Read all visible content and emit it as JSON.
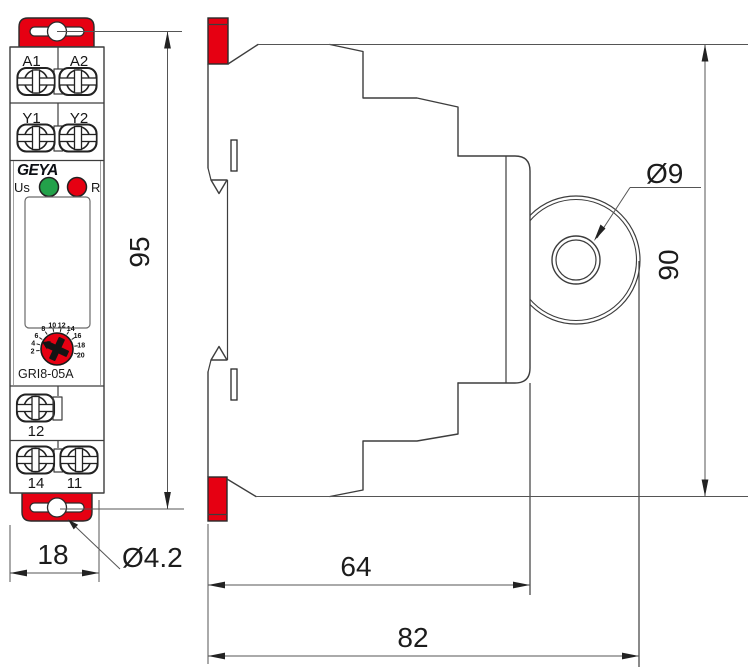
{
  "drawing": {
    "front_view": {
      "terminal_labels_row1": [
        "A1",
        "A2"
      ],
      "terminal_labels_row2": [
        "Y1",
        "Y2"
      ],
      "brand": "GEYA",
      "led_power_label": "Us",
      "led_relay_label": "R",
      "model": "GRI8-05A",
      "dial_scale": [
        "2",
        "4",
        "6",
        "8",
        "10",
        "12",
        "14",
        "16",
        "18",
        "20"
      ],
      "terminal_label_12": "12",
      "terminal_label_14": "14",
      "terminal_label_11": "11"
    },
    "dimensions": {
      "front_height": "95",
      "front_width": "18",
      "front_hole_diameter": "Ø4.2",
      "side_height": "90",
      "side_hole_diameter": "Ø9",
      "side_depth_inner": "64",
      "side_depth_total": "82"
    },
    "colors": {
      "accent_red": "#e60012",
      "led_green": "#23a14a",
      "line_dark": "#3d3d3d"
    }
  }
}
